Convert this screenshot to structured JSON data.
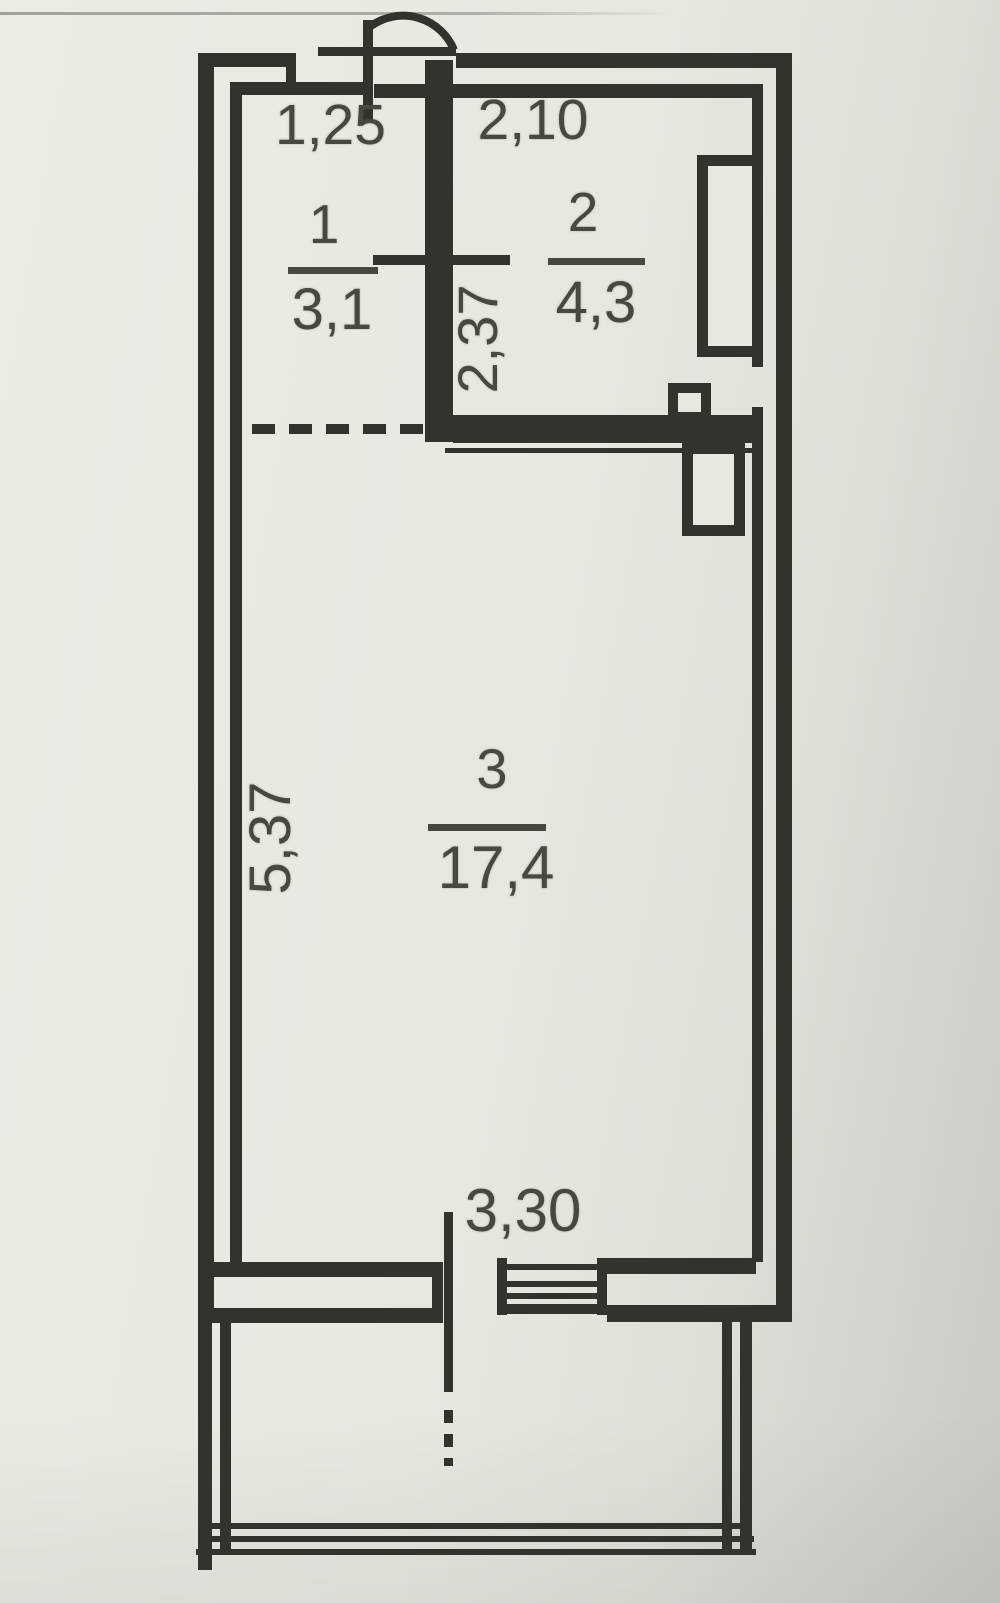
{
  "title": "Apartment floor plan (BTI scheme)",
  "colors": {
    "paper": "#e9e6e0",
    "ink": "#34322d",
    "text": "#4a4741"
  },
  "plan": {
    "rooms": [
      {
        "number": "1",
        "area": "3,1"
      },
      {
        "number": "2",
        "area": "4,3"
      },
      {
        "number": "3",
        "area": "17,4"
      }
    ],
    "dimensions": {
      "entry_width": "1,25",
      "room2_width": "2,10",
      "room2_depth": "2,37",
      "room3_depth": "5,37",
      "room3_width": "3,30"
    }
  }
}
